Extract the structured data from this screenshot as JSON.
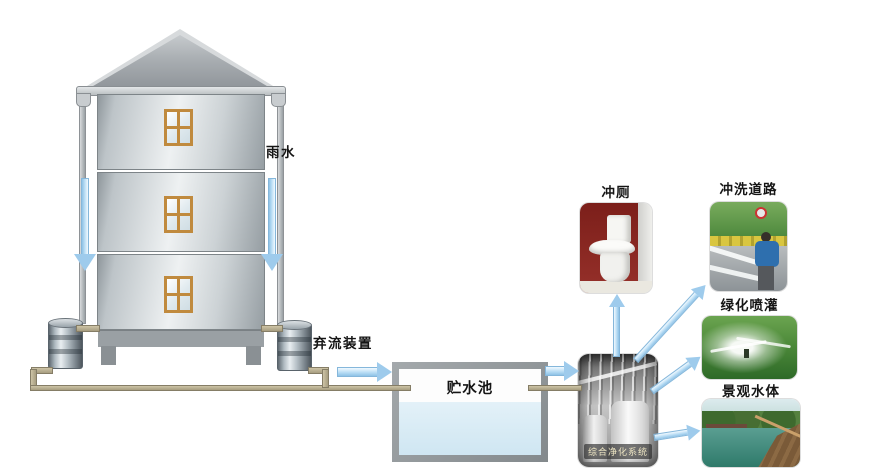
{
  "labels": {
    "rain": "雨水",
    "discard_device": "弃流装置",
    "storage_tank": "贮水池",
    "purification_system": "综合净化系统",
    "toilet_flushing": "冲厕",
    "road_washing": "冲洗道路",
    "green_irrigation": "绿化喷灌",
    "landscape_water": "景观水体"
  },
  "colors": {
    "arrow_fill": "#9ecbec",
    "arrow_edge": "#85b7db",
    "pipe": "#b3a98c",
    "tank_water": "#d5e9f4",
    "tank_border": "#8f9496",
    "window_frame": "#c08a3e",
    "toilet_photo_bg": "#8c2a22"
  },
  "flow_connections": [
    {
      "from": "雨水",
      "to": "弃流装置"
    },
    {
      "from": "弃流装置",
      "to": "贮水池"
    },
    {
      "from": "贮水池",
      "to": "综合净化系统"
    },
    {
      "from": "综合净化系统",
      "to": "冲厕"
    },
    {
      "from": "综合净化系统",
      "to": "冲洗道路"
    },
    {
      "from": "综合净化系统",
      "to": "绿化喷灌"
    },
    {
      "from": "综合净化系统",
      "to": "景观水体"
    }
  ]
}
